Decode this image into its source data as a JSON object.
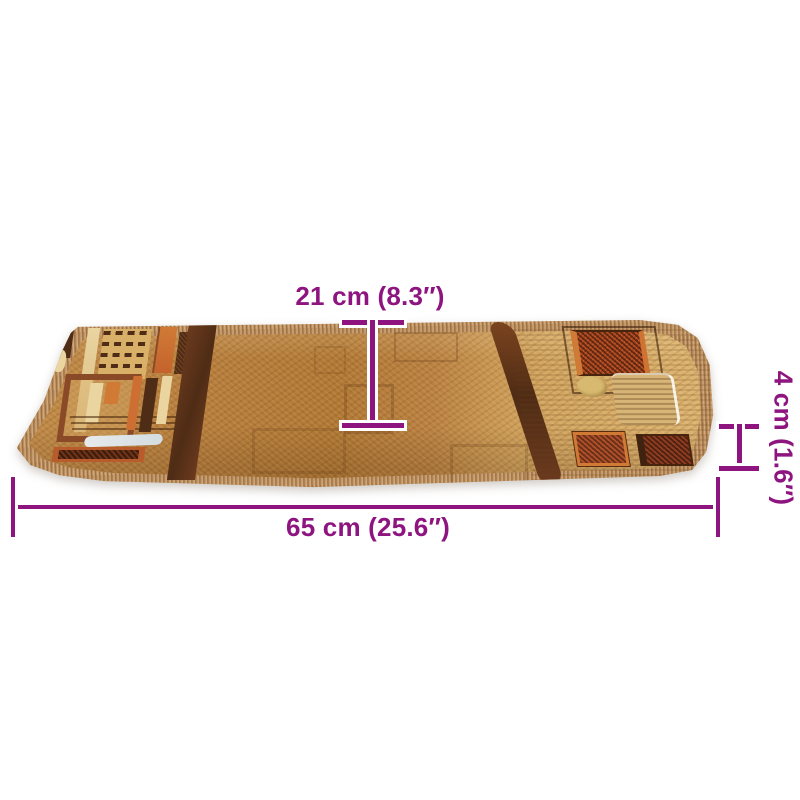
{
  "diagram": {
    "labels": {
      "depth": "21 cm (8.3″)",
      "thickness": "4 cm (1.6″)",
      "width": "65 cm (25.6″)"
    },
    "colors": {
      "dimension": "#8E1580",
      "casing": "#FFFFFF",
      "background": "#FFFFFF",
      "rug_edge": "#BB8D5C",
      "rug_field": "#B67D3C",
      "rug_field_light": "#DDB572",
      "pattern_dark": "#4F2C15",
      "pattern_rust": "#A8441F",
      "pattern_orange": "#D07A36",
      "pattern_cream": "#EAD4A0",
      "pattern_gold": "#D7B96F",
      "pattern_blue": "#D4DDE1"
    }
  }
}
